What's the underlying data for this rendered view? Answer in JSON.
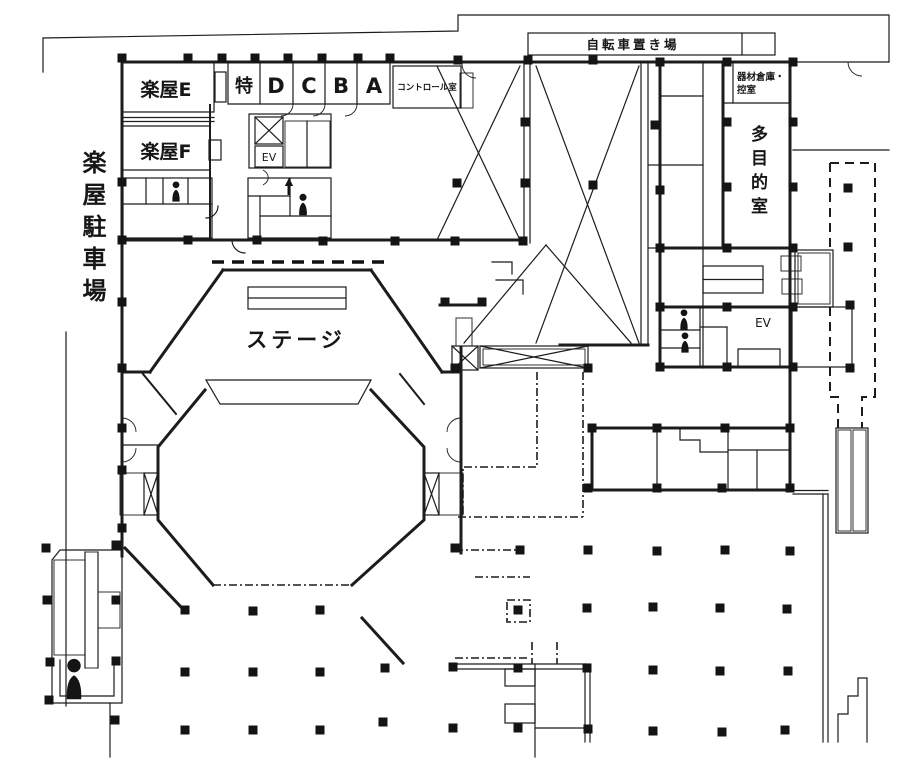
{
  "labels": {
    "parking_vertical": "楽屋駐車場",
    "dressing_e": "楽屋E",
    "dressing_f": "楽屋F",
    "room_special": "特",
    "room_d": "D",
    "room_c": "C",
    "room_b": "B",
    "room_a": "A",
    "control_room": "コントロール室",
    "bicycle_parking": "自転車置き場",
    "equipment_line1": "器材倉庫・",
    "equipment_line2": "控室",
    "multipurpose_vertical": "多目的室",
    "stage": "ステージ",
    "elevator_left": "EV",
    "elevator_right": "EV"
  },
  "colors": {
    "ink": "#1c1c1c",
    "paper": "#ffffff"
  }
}
